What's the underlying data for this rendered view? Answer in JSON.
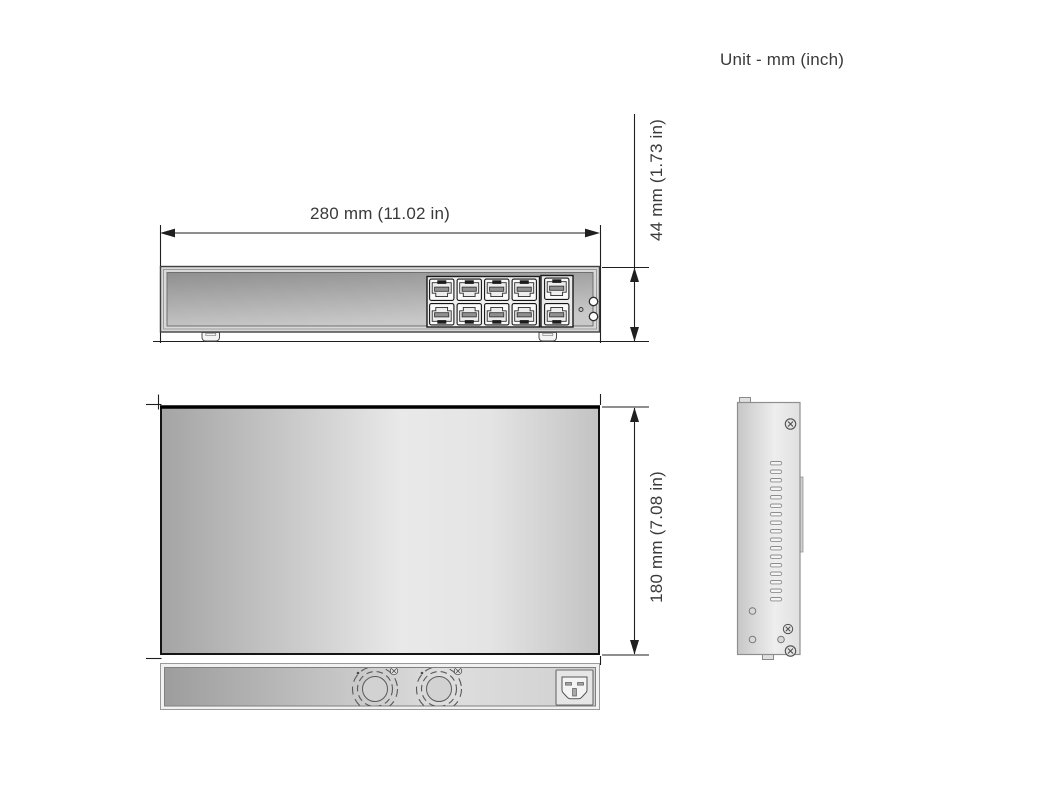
{
  "labels": {
    "unit_note": "Unit - mm (inch)",
    "width": "280 mm (11.02 in)",
    "height": "44 mm (1.73 in)",
    "depth": "180 mm (7.08 in)"
  },
  "figure": {
    "type": "technical-dimension-diagram",
    "subject": "rack-mount network switch",
    "views": [
      "front",
      "top",
      "side",
      "rear"
    ],
    "front_view": {
      "rj45_ports": 8,
      "uplink_ports": 2,
      "indicator_leds": 2,
      "feet": 2
    },
    "rear_view": {
      "fans": 2,
      "power_inlet": "IEC C14"
    },
    "side_view": {
      "vent_slots": 17,
      "screws": 3,
      "holes": 3
    },
    "colors": {
      "line": "#1f1f1f",
      "text": "#3a3a3a",
      "panel_dark": "#a4a4a4",
      "panel_light": "#ececec",
      "background": "#ffffff"
    }
  }
}
